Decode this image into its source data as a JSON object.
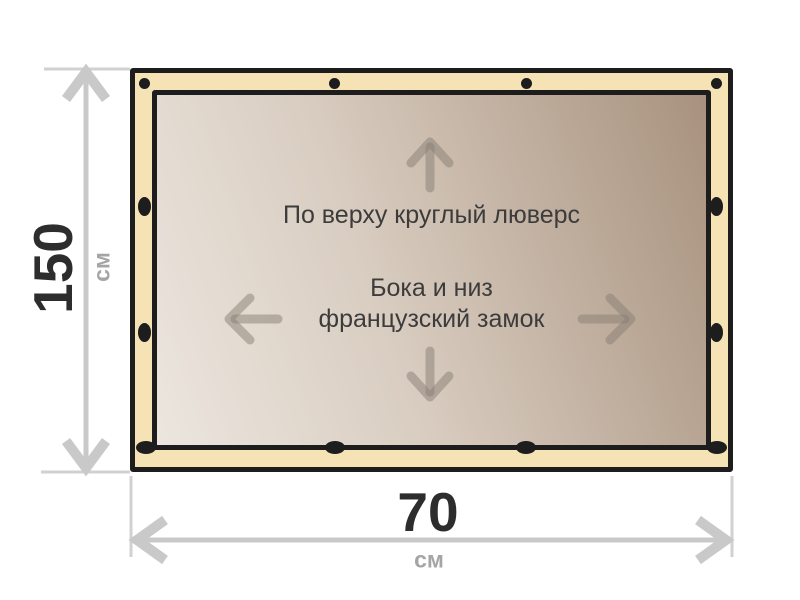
{
  "diagram": {
    "type": "banner-specification",
    "banner": {
      "top_note": "По верху круглый люверс",
      "middle_note_line1": "Бока и низ",
      "middle_note_line2": "французский замок",
      "fasteners": {
        "top_style": "round-grommet",
        "sides_bottom_style": "french-lock-oval",
        "top_count": 4,
        "bottom_count": 4,
        "side_count_each": 2
      },
      "direction_arrows": [
        "up",
        "left",
        "right",
        "down"
      ]
    },
    "dimensions": {
      "height": {
        "value": "150",
        "unit": "см"
      },
      "width": {
        "value": "70",
        "unit": "см"
      }
    },
    "colors": {
      "banner_edge": "#f5e2b5",
      "banner_border": "#1d1d1d",
      "canvas_gradient_light": "#ece6df",
      "canvas_gradient_dark": "#a8927e",
      "dimension_lines": "#c9c9c9",
      "dimension_value_text": "#2d2d2d",
      "dimension_unit_text": "#a5a5a5",
      "note_text": "#3c3c3c",
      "inner_arrows": "#877d74"
    }
  }
}
